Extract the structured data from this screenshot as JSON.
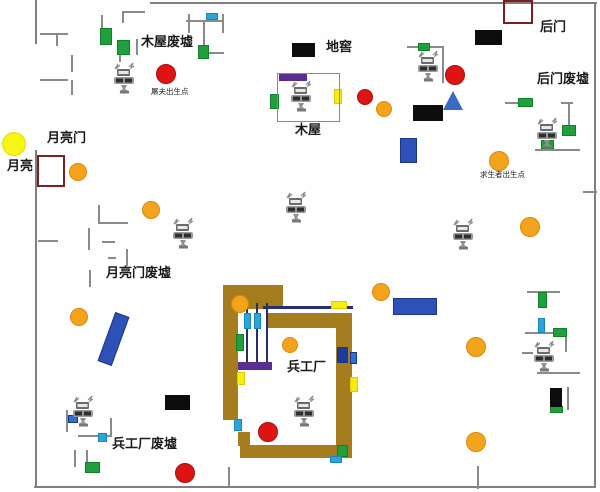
{
  "map": {
    "title": "生化金字塔地图 (biochemical game map)",
    "width": 600,
    "height": 492,
    "palette": {
      "border": "#7f7f7f",
      "wall": "#8a8a8a",
      "green": "#1fa03c",
      "green_border": "#12802a",
      "cyan": "#2aa5dc",
      "cyan_border": "#1b86b8",
      "blue": "#2e51b8",
      "blue_border": "#1c3584",
      "navy": "#1d3a9e",
      "midblue": "#2e6fd0",
      "purple": "#5c2d91",
      "brown": "#a57d1e",
      "orange": "#f3a41c",
      "orange_border": "#d98a0a",
      "red": "#de1414",
      "red_border": "#a80f0f",
      "yellow": "#f6ee12",
      "yellow_border": "#d8ce00",
      "moon": "#f7f516",
      "moon_border": "#e4de00",
      "black": "#0d0d0d",
      "darkred": "#7b1f1f",
      "rail": "#26306e",
      "label": "#1a1a1a"
    },
    "labels": [
      {
        "name": "label-muwu-feixu",
        "text": "木屋废墟",
        "x": 141,
        "y": 36,
        "size": 13,
        "bold": true
      },
      {
        "name": "label-dijiao",
        "text": "地窖",
        "x": 326,
        "y": 41,
        "size": 13,
        "bold": true
      },
      {
        "name": "label-houmen",
        "text": "后门",
        "x": 540,
        "y": 21,
        "size": 13,
        "bold": true
      },
      {
        "name": "label-houmen-feixu",
        "text": "后门废墟",
        "x": 537,
        "y": 73,
        "size": 13,
        "bold": true
      },
      {
        "name": "label-tufu-spawn",
        "text": "屠夫出生点",
        "x": 151,
        "y": 88,
        "size": 7.5,
        "bold": false
      },
      {
        "name": "label-muwu",
        "text": "木屋",
        "x": 295,
        "y": 124,
        "size": 13,
        "bold": true
      },
      {
        "name": "label-yueliangmen",
        "text": "月亮门",
        "x": 47,
        "y": 132,
        "size": 13,
        "bold": true
      },
      {
        "name": "label-yueliang",
        "text": "月亮",
        "x": 7,
        "y": 160,
        "size": 13,
        "bold": true
      },
      {
        "name": "label-qiushengzhe-spawn",
        "text": "求生者出生点",
        "x": 480,
        "y": 171,
        "size": 7.5,
        "bold": false
      },
      {
        "name": "label-yueliangmen-feixu",
        "text": "月亮门废墟",
        "x": 106,
        "y": 267,
        "size": 13,
        "bold": true
      },
      {
        "name": "label-binggongchang",
        "text": "兵工厂",
        "x": 287,
        "y": 361,
        "size": 13,
        "bold": true
      },
      {
        "name": "label-binggongchang-feixu",
        "text": "兵工厂废墟",
        "x": 112,
        "y": 438,
        "size": 13,
        "bold": true
      }
    ],
    "borders": [
      {
        "name": "map-border-top",
        "x": 150,
        "y": 2,
        "w": 447,
        "h": 2
      },
      {
        "name": "map-border-right",
        "x": 594,
        "y": 2,
        "w": 2,
        "h": 486
      },
      {
        "name": "map-border-bottom",
        "x": 34,
        "y": 486,
        "w": 562,
        "h": 2
      },
      {
        "name": "map-border-left-upper",
        "x": 35,
        "y": 0,
        "w": 2,
        "h": 44
      },
      {
        "name": "map-border-left-lower",
        "x": 35,
        "y": 150,
        "w": 2,
        "h": 337
      }
    ],
    "walls": [
      {
        "name": "ruin-wall",
        "x": 40,
        "y": 33,
        "w": 28,
        "h": 2
      },
      {
        "name": "ruin-wall",
        "x": 56,
        "y": 33,
        "w": 2,
        "h": 13
      },
      {
        "name": "ruin-wall",
        "x": 71,
        "y": 55,
        "w": 2,
        "h": 17
      },
      {
        "name": "ruin-wall",
        "x": 71,
        "y": 80,
        "w": 2,
        "h": 15
      },
      {
        "name": "ruin-wall",
        "x": 40,
        "y": 79,
        "w": 28,
        "h": 2
      },
      {
        "name": "ruin-wall",
        "x": 101,
        "y": 15,
        "w": 2,
        "h": 14
      },
      {
        "name": "ruin-wall",
        "x": 122,
        "y": 11,
        "w": 23,
        "h": 2
      },
      {
        "name": "ruin-wall",
        "x": 122,
        "y": 11,
        "w": 2,
        "h": 12
      },
      {
        "name": "ruin-wall",
        "x": 136,
        "y": 39,
        "w": 2,
        "h": 16
      },
      {
        "name": "ruin-wall",
        "x": 119,
        "y": 55,
        "w": 2,
        "h": 7
      },
      {
        "name": "ruin-wall",
        "x": 186,
        "y": 20,
        "w": 38,
        "h": 2
      },
      {
        "name": "ruin-wall",
        "x": 188,
        "y": 14,
        "w": 2,
        "h": 19
      },
      {
        "name": "ruin-wall",
        "x": 203,
        "y": 20,
        "w": 2,
        "h": 27
      },
      {
        "name": "ruin-wall",
        "x": 222,
        "y": 14,
        "w": 2,
        "h": 19
      },
      {
        "name": "ruin-wall",
        "x": 208,
        "y": 52,
        "w": 16,
        "h": 2
      },
      {
        "name": "ruin-wall",
        "x": 407,
        "y": 46,
        "w": 37,
        "h": 2
      },
      {
        "name": "ruin-wall",
        "x": 442,
        "y": 46,
        "w": 2,
        "h": 37
      },
      {
        "name": "ruin-wall",
        "x": 505,
        "y": 102,
        "w": 14,
        "h": 2
      },
      {
        "name": "ruin-wall",
        "x": 561,
        "y": 102,
        "w": 12,
        "h": 2
      },
      {
        "name": "ruin-wall",
        "x": 568,
        "y": 102,
        "w": 2,
        "h": 23
      },
      {
        "name": "ruin-wall",
        "x": 535,
        "y": 149,
        "w": 45,
        "h": 2
      },
      {
        "name": "ruin-wall",
        "x": 583,
        "y": 191,
        "w": 14,
        "h": 2
      },
      {
        "name": "ruin-wall",
        "x": 98,
        "y": 205,
        "w": 2,
        "h": 19
      },
      {
        "name": "ruin-wall",
        "x": 98,
        "y": 222,
        "w": 30,
        "h": 2
      },
      {
        "name": "ruin-wall",
        "x": 88,
        "y": 228,
        "w": 2,
        "h": 22
      },
      {
        "name": "ruin-wall",
        "x": 102,
        "y": 241,
        "w": 13,
        "h": 2
      },
      {
        "name": "ruin-wall",
        "x": 108,
        "y": 257,
        "w": 8,
        "h": 2
      },
      {
        "name": "ruin-wall",
        "x": 126,
        "y": 249,
        "w": 2,
        "h": 17
      },
      {
        "name": "ruin-wall",
        "x": 89,
        "y": 270,
        "w": 2,
        "h": 17
      },
      {
        "name": "ruin-wall",
        "x": 38,
        "y": 240,
        "w": 20,
        "h": 2
      },
      {
        "name": "ruin-wall",
        "x": 66,
        "y": 410,
        "w": 2,
        "h": 22
      },
      {
        "name": "ruin-wall",
        "x": 78,
        "y": 435,
        "w": 32,
        "h": 2
      },
      {
        "name": "ruin-wall",
        "x": 110,
        "y": 418,
        "w": 2,
        "h": 19
      },
      {
        "name": "ruin-wall",
        "x": 74,
        "y": 450,
        "w": 2,
        "h": 17
      },
      {
        "name": "ruin-wall",
        "x": 86,
        "y": 450,
        "w": 2,
        "h": 12
      },
      {
        "name": "ruin-wall",
        "x": 228,
        "y": 467,
        "w": 2,
        "h": 20
      },
      {
        "name": "ruin-wall",
        "x": 477,
        "y": 466,
        "w": 2,
        "h": 23
      },
      {
        "name": "ruin-wall",
        "x": 527,
        "y": 291,
        "w": 33,
        "h": 2
      },
      {
        "name": "ruin-wall",
        "x": 525,
        "y": 332,
        "w": 28,
        "h": 2
      },
      {
        "name": "ruin-wall",
        "x": 565,
        "y": 337,
        "w": 2,
        "h": 15
      },
      {
        "name": "ruin-wall",
        "x": 522,
        "y": 352,
        "w": 11,
        "h": 2
      },
      {
        "name": "ruin-wall",
        "x": 537,
        "y": 372,
        "w": 43,
        "h": 2
      },
      {
        "name": "ruin-wall",
        "x": 567,
        "y": 387,
        "w": 2,
        "h": 23
      }
    ],
    "brown_walls": [
      {
        "name": "arsenal-wall-top-left",
        "x": 223,
        "y": 285,
        "w": 60,
        "h": 24
      },
      {
        "name": "arsenal-wall-top-right",
        "x": 268,
        "y": 313,
        "w": 84,
        "h": 15
      },
      {
        "name": "arsenal-wall-left",
        "x": 223,
        "y": 309,
        "w": 15,
        "h": 111
      },
      {
        "name": "arsenal-wall-step",
        "x": 238,
        "y": 432,
        "w": 12,
        "h": 14
      },
      {
        "name": "arsenal-wall-bottom",
        "x": 240,
        "y": 445,
        "w": 112,
        "h": 13
      },
      {
        "name": "arsenal-wall-right",
        "x": 336,
        "y": 328,
        "w": 16,
        "h": 130
      }
    ],
    "rails": [
      {
        "name": "arsenal-blue-beam",
        "x": 263,
        "y": 306,
        "w": 90,
        "h": 3
      },
      {
        "name": "arsenal-rail",
        "x": 246,
        "y": 303,
        "w": 2,
        "h": 60
      },
      {
        "name": "arsenal-rail",
        "x": 256,
        "y": 303,
        "w": 2,
        "h": 60
      },
      {
        "name": "arsenal-rail",
        "x": 266,
        "y": 303,
        "w": 2,
        "h": 60
      }
    ],
    "rects": [
      {
        "name": "green-crate",
        "x": 100,
        "y": 28,
        "w": 12,
        "h": 17,
        "c": "green"
      },
      {
        "name": "green-crate",
        "x": 117,
        "y": 40,
        "w": 13,
        "h": 15,
        "c": "green"
      },
      {
        "name": "green-crate",
        "x": 198,
        "y": 45,
        "w": 11,
        "h": 14,
        "c": "green"
      },
      {
        "name": "green-crate",
        "x": 418,
        "y": 43,
        "w": 12,
        "h": 8,
        "c": "green"
      },
      {
        "name": "green-crate",
        "x": 270,
        "y": 94,
        "w": 9,
        "h": 15,
        "c": "green"
      },
      {
        "name": "green-crate",
        "x": 518,
        "y": 98,
        "w": 15,
        "h": 9,
        "c": "green"
      },
      {
        "name": "green-crate",
        "x": 562,
        "y": 125,
        "w": 14,
        "h": 11,
        "c": "green"
      },
      {
        "name": "green-crate",
        "x": 541,
        "y": 140,
        "w": 13,
        "h": 9,
        "c": "green"
      },
      {
        "name": "green-crate",
        "x": 538,
        "y": 292,
        "w": 9,
        "h": 16,
        "c": "green"
      },
      {
        "name": "green-crate",
        "x": 553,
        "y": 328,
        "w": 14,
        "h": 9,
        "c": "green"
      },
      {
        "name": "green-crate",
        "x": 550,
        "y": 406,
        "w": 13,
        "h": 7,
        "c": "green"
      },
      {
        "name": "green-crate",
        "x": 236,
        "y": 334,
        "w": 8,
        "h": 17,
        "c": "green"
      },
      {
        "name": "green-crate",
        "x": 337,
        "y": 445,
        "w": 11,
        "h": 12,
        "c": "green"
      },
      {
        "name": "green-crate",
        "x": 85,
        "y": 462,
        "w": 15,
        "h": 11,
        "c": "green"
      },
      {
        "name": "cyan-marker",
        "x": 206,
        "y": 13,
        "w": 12,
        "h": 7,
        "c": "cyan"
      },
      {
        "name": "cyan-marker",
        "x": 244,
        "y": 313,
        "w": 7,
        "h": 16,
        "c": "cyan"
      },
      {
        "name": "cyan-marker",
        "x": 254,
        "y": 313,
        "w": 7,
        "h": 16,
        "c": "cyan"
      },
      {
        "name": "cyan-marker",
        "x": 234,
        "y": 419,
        "w": 8,
        "h": 12,
        "c": "cyan"
      },
      {
        "name": "cyan-marker",
        "x": 330,
        "y": 456,
        "w": 12,
        "h": 7,
        "c": "cyan"
      },
      {
        "name": "cyan-marker",
        "x": 98,
        "y": 433,
        "w": 9,
        "h": 9,
        "c": "cyan"
      },
      {
        "name": "cyan-marker",
        "x": 538,
        "y": 318,
        "w": 7,
        "h": 15,
        "c": "cyan"
      },
      {
        "name": "cyan-marker",
        "x": 68,
        "y": 415,
        "w": 10,
        "h": 8,
        "c": "midblue"
      },
      {
        "name": "yellow-marker",
        "x": 334,
        "y": 89,
        "w": 8,
        "h": 15,
        "c": "yellow"
      },
      {
        "name": "yellow-marker",
        "x": 331,
        "y": 301,
        "w": 16,
        "h": 8,
        "c": "yellow"
      },
      {
        "name": "yellow-marker",
        "x": 237,
        "y": 372,
        "w": 8,
        "h": 13,
        "c": "yellow"
      },
      {
        "name": "yellow-marker",
        "x": 350,
        "y": 377,
        "w": 8,
        "h": 15,
        "c": "yellow"
      },
      {
        "name": "purple-beam",
        "x": 279,
        "y": 74,
        "w": 28,
        "h": 7,
        "c": "purple"
      },
      {
        "name": "purple-beam",
        "x": 238,
        "y": 362,
        "w": 34,
        "h": 8,
        "c": "purple"
      },
      {
        "name": "black-block",
        "x": 292,
        "y": 43,
        "w": 23,
        "h": 14,
        "c": "black"
      },
      {
        "name": "black-block",
        "x": 475,
        "y": 30,
        "w": 27,
        "h": 15,
        "c": "black"
      },
      {
        "name": "black-block",
        "x": 413,
        "y": 105,
        "w": 30,
        "h": 16,
        "c": "black"
      },
      {
        "name": "black-block",
        "x": 165,
        "y": 395,
        "w": 25,
        "h": 15,
        "c": "black"
      },
      {
        "name": "black-block",
        "x": 550,
        "y": 388,
        "w": 12,
        "h": 19,
        "c": "black"
      },
      {
        "name": "blue-crate",
        "x": 400,
        "y": 138,
        "w": 17,
        "h": 25,
        "c": "blue"
      },
      {
        "name": "blue-crate",
        "x": 393,
        "y": 298,
        "w": 44,
        "h": 17,
        "c": "blue"
      },
      {
        "name": "blue-crate-tilted",
        "x": 106,
        "y": 313,
        "w": 15,
        "h": 52,
        "c": "blue",
        "rot": 20
      },
      {
        "name": "navy-marker",
        "x": 337,
        "y": 347,
        "w": 11,
        "h": 16,
        "c": "navy"
      },
      {
        "name": "blue-marker",
        "x": 350,
        "y": 352,
        "w": 7,
        "h": 12,
        "c": "midblue"
      }
    ],
    "outlines": [
      {
        "name": "wooden-house-outline",
        "x": 277,
        "y": 73,
        "w": 63,
        "h": 49,
        "stroke": "#8a8a8a",
        "sw": 1
      },
      {
        "name": "backdoor-gate-outline",
        "x": 503,
        "y": 0,
        "w": 30,
        "h": 24,
        "stroke": "#7b1f1f",
        "sw": 2
      },
      {
        "name": "moongate-outline",
        "x": 37,
        "y": 155,
        "w": 28,
        "h": 32,
        "stroke": "#7b1f1f",
        "sw": 2
      }
    ],
    "circles": [
      {
        "name": "moon",
        "cx": 14,
        "cy": 144,
        "r": 12,
        "c": "moon"
      },
      {
        "name": "orange-spot",
        "cx": 78,
        "cy": 172,
        "r": 9,
        "c": "orange"
      },
      {
        "name": "orange-spot",
        "cx": 151,
        "cy": 210,
        "r": 9,
        "c": "orange"
      },
      {
        "name": "orange-spot",
        "cx": 384,
        "cy": 109,
        "r": 8,
        "c": "orange"
      },
      {
        "name": "orange-spot",
        "cx": 499,
        "cy": 161,
        "r": 10,
        "c": "orange"
      },
      {
        "name": "orange-spot",
        "cx": 530,
        "cy": 227,
        "r": 10,
        "c": "orange"
      },
      {
        "name": "orange-spot",
        "cx": 79,
        "cy": 317,
        "r": 9,
        "c": "orange"
      },
      {
        "name": "orange-spot",
        "cx": 240,
        "cy": 304,
        "r": 9,
        "c": "orange"
      },
      {
        "name": "orange-spot",
        "cx": 290,
        "cy": 345,
        "r": 8,
        "c": "orange"
      },
      {
        "name": "orange-spot",
        "cx": 381,
        "cy": 292,
        "r": 9,
        "c": "orange"
      },
      {
        "name": "orange-spot",
        "cx": 476,
        "cy": 347,
        "r": 10,
        "c": "orange"
      },
      {
        "name": "orange-spot",
        "cx": 476,
        "cy": 442,
        "r": 10,
        "c": "orange"
      },
      {
        "name": "red-spot",
        "cx": 166,
        "cy": 74,
        "r": 10,
        "c": "red"
      },
      {
        "name": "red-spot",
        "cx": 365,
        "cy": 97,
        "r": 8,
        "c": "red"
      },
      {
        "name": "red-spot",
        "cx": 455,
        "cy": 75,
        "r": 10,
        "c": "red"
      },
      {
        "name": "red-spot",
        "cx": 268,
        "cy": 432,
        "r": 10,
        "c": "red"
      },
      {
        "name": "red-spot",
        "cx": 185,
        "cy": 473,
        "r": 10,
        "c": "red"
      }
    ],
    "triangles": [
      {
        "name": "blue-triangle",
        "x": 443,
        "y": 91,
        "w": 20,
        "h": 19,
        "c": "#3a6bc4"
      }
    ],
    "robots": [
      {
        "name": "mech-icon",
        "cx": 124,
        "cy": 79
      },
      {
        "name": "mech-icon",
        "cx": 301,
        "cy": 97
      },
      {
        "name": "mech-icon",
        "cx": 428,
        "cy": 67
      },
      {
        "name": "mech-icon",
        "cx": 547,
        "cy": 134
      },
      {
        "name": "mech-icon",
        "cx": 183,
        "cy": 234
      },
      {
        "name": "mech-icon",
        "cx": 296,
        "cy": 208
      },
      {
        "name": "mech-icon",
        "cx": 463,
        "cy": 235
      },
      {
        "name": "mech-icon",
        "cx": 83,
        "cy": 412
      },
      {
        "name": "mech-icon",
        "cx": 304,
        "cy": 412
      },
      {
        "name": "mech-icon",
        "cx": 544,
        "cy": 357
      }
    ]
  }
}
